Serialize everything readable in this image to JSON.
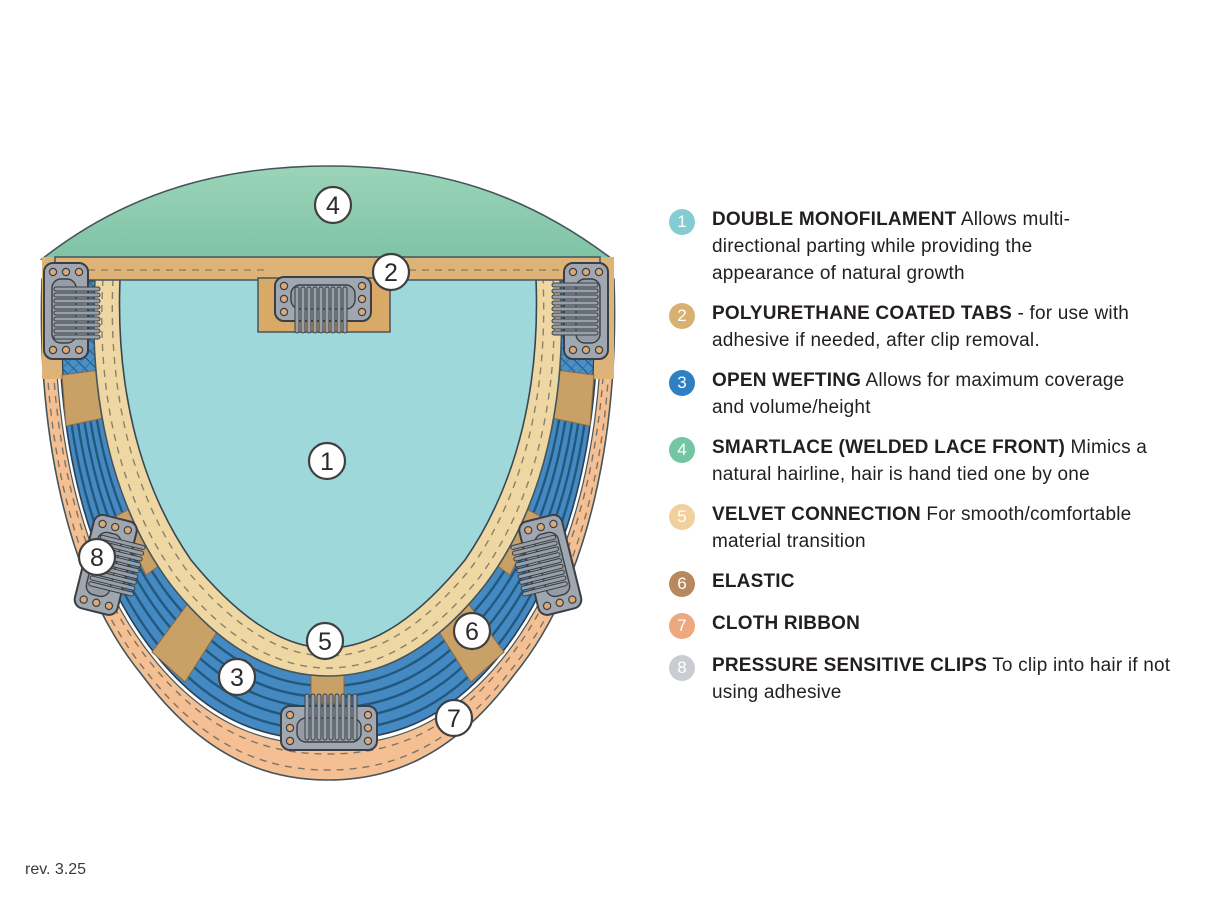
{
  "page": {
    "revision": "rev. 3.25"
  },
  "diagram": {
    "callouts": [
      {
        "n": "1"
      },
      {
        "n": "2"
      },
      {
        "n": "3"
      },
      {
        "n": "4"
      },
      {
        "n": "5"
      },
      {
        "n": "6"
      },
      {
        "n": "7"
      },
      {
        "n": "8"
      }
    ],
    "colors": {
      "monofilament": "#9fd8da",
      "lace_front": "#8ccbb1",
      "open_wefting": "#4489c2",
      "velvet_connection": "#efd7a3",
      "cloth_ribbon": "#f4bf92",
      "elastic": "#c9a065",
      "coated_tab": "#ddb377",
      "clip_metal": "#a0a7b0"
    }
  },
  "legend": {
    "items": [
      {
        "number": "1",
        "color": "#82ccd2",
        "title": "DOUBLE MONOFILAMENT",
        "tail": " Allows multi-",
        "lines": [
          "directional parting while providing the",
          "appearance of natural growth"
        ]
      },
      {
        "number": "2",
        "color": "#d8b171",
        "title": "POLYURETHANE COATED TABS",
        "tail": " - for use with",
        "lines": [
          "adhesive if needed, after clip removal."
        ]
      },
      {
        "number": "3",
        "color": "#2e7fc4",
        "title": "OPEN WEFTING",
        "tail": " Allows for maximum coverage",
        "lines": [
          "and volume/height"
        ]
      },
      {
        "number": "4",
        "color": "#74c6a3",
        "title": "SMARTLACE (WELDED LACE FRONT)",
        "tail": " Mimics a",
        "lines": [
          "natural hairline, hair is hand tied one by one"
        ]
      },
      {
        "number": "5",
        "color": "#f2d09e",
        "title": "VELVET CONNECTION",
        "tail": " For smooth/comfortable",
        "lines": [
          "material transition"
        ]
      },
      {
        "number": "6",
        "color": "#b8895e",
        "title": "ELASTIC",
        "tail": "",
        "lines": []
      },
      {
        "number": "7",
        "color": "#eda87d",
        "title": "CLOTH RIBBON",
        "tail": "",
        "lines": []
      },
      {
        "number": "8",
        "color": "#c9cdd2",
        "title": "PRESSURE SENSITIVE CLIPS",
        "tail": " To clip into hair if not",
        "lines": [
          "using adhesive"
        ]
      }
    ]
  }
}
